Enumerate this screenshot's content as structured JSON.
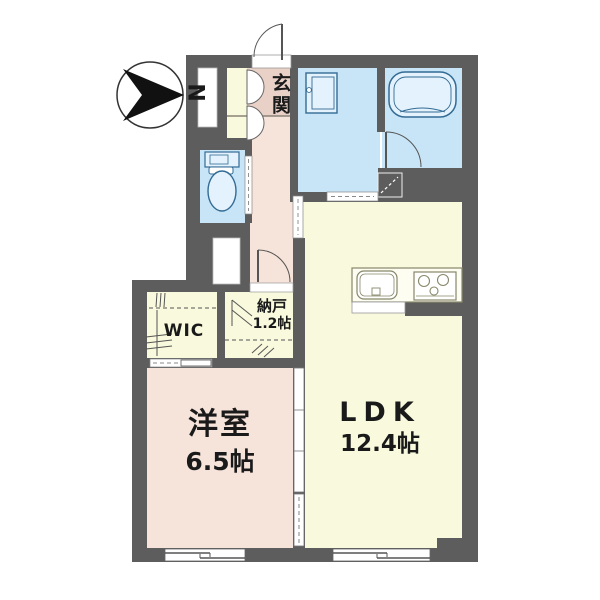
{
  "compass": {
    "label": "N"
  },
  "rooms": {
    "genkan": {
      "label": "玄関"
    },
    "wic": {
      "label": "WIC"
    },
    "storage": {
      "label": "納戸",
      "size": "1.2帖"
    },
    "bedroom": {
      "label": "洋室",
      "size": "6.5帖"
    },
    "ldk": {
      "label": "LDK",
      "size": "12.4帖"
    }
  },
  "colors": {
    "wall": "#5d5d5d",
    "floor_pink": "#f6e3da",
    "genkan_tile": "#e9d1c7",
    "floor_cream": "#f9f9dd",
    "water_blue": "#c8e5f7",
    "fixture_blue_fill": "#e3f2fc",
    "fixture_blue_stroke": "#336b94",
    "kitchen_stroke": "#88876a",
    "door_white": "#ffffff",
    "text": "#1a1a1a"
  }
}
